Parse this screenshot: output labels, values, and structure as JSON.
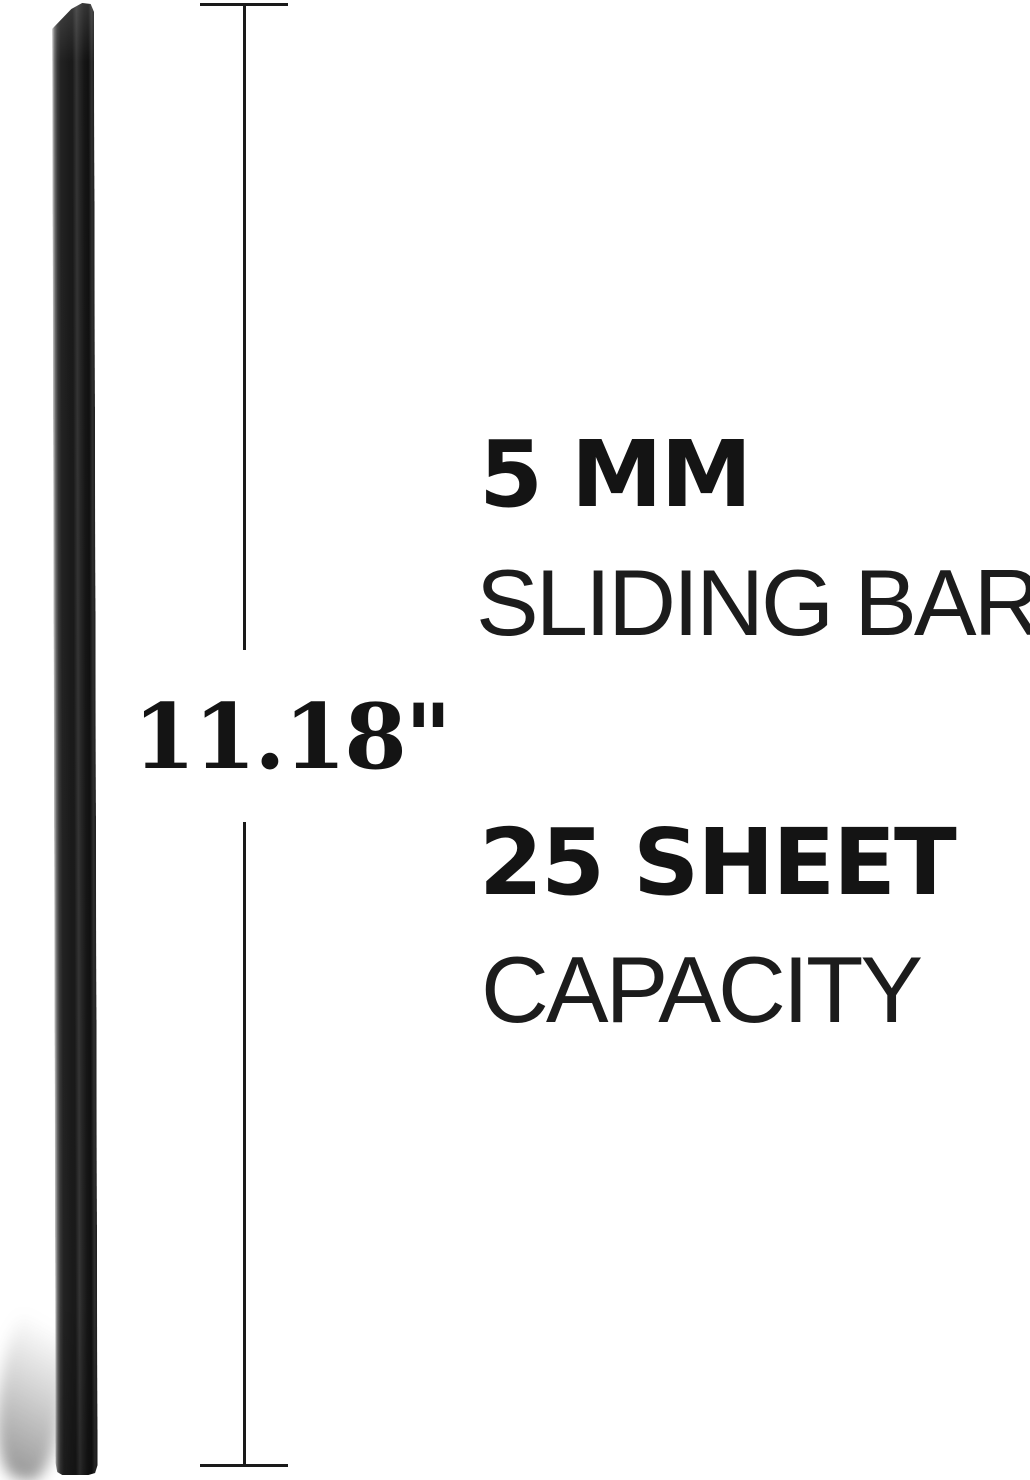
{
  "measurement": {
    "length_label": "11.18\""
  },
  "specs": [
    {
      "bold": "5 MM",
      "light": "SLIDING BAR"
    },
    {
      "bold": "25 SHEET",
      "light": "CAPACITY"
    }
  ],
  "colors": {
    "background": "#ffffff",
    "text_bold": "#141414",
    "text_light": "#1c1c1c",
    "dimension_line": "#1a1a1a",
    "bar_body": "#1b1b1b",
    "bar_highlight": "#9b9b9b"
  }
}
